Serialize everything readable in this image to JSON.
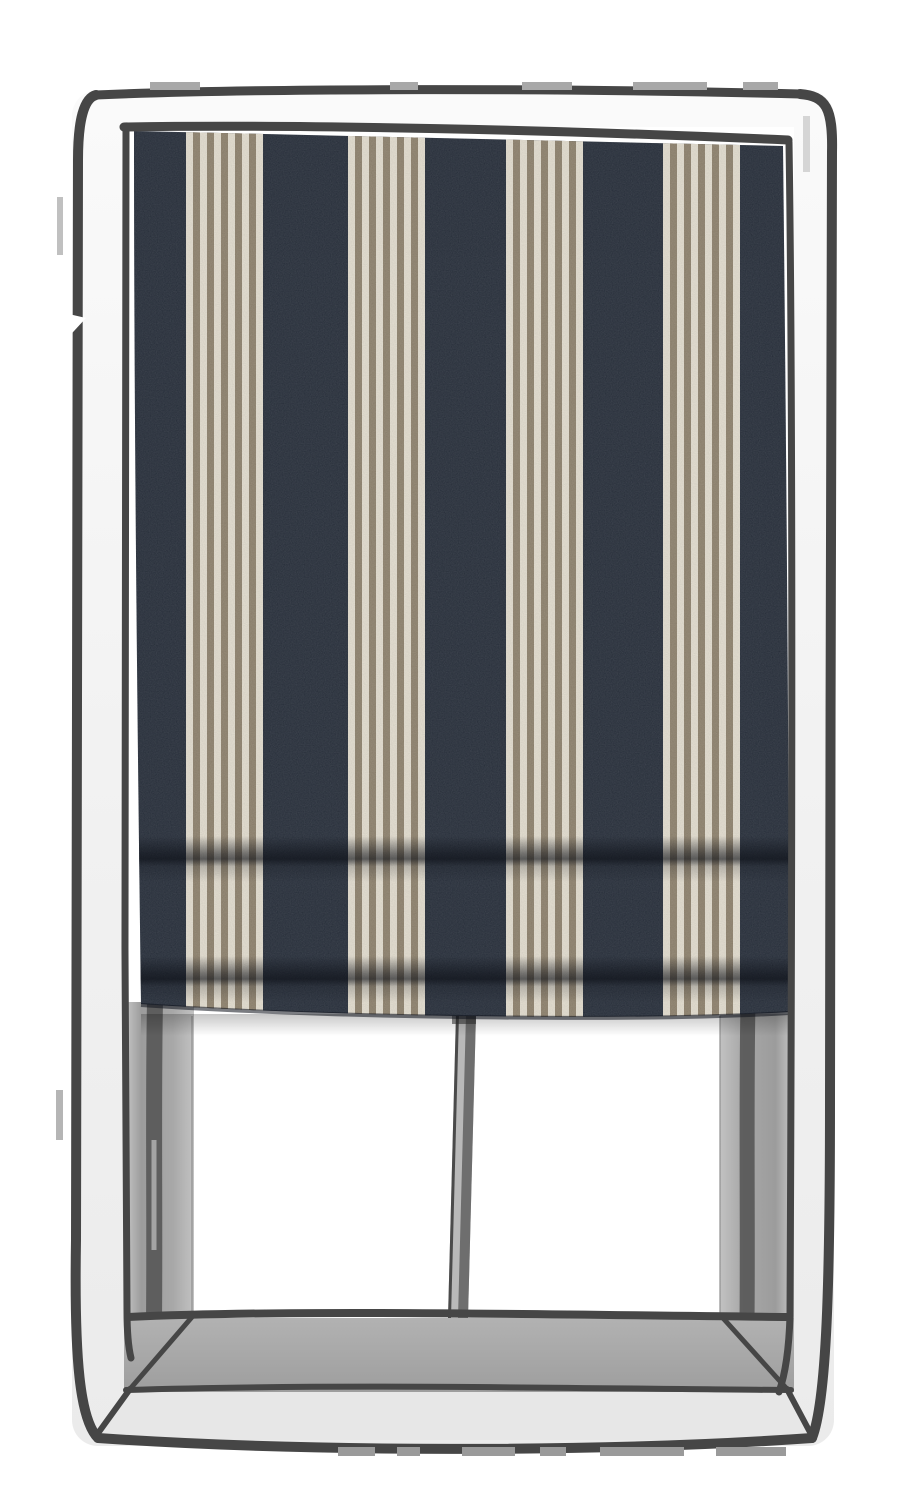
{
  "window_product_image": {
    "description": "Hand-sketched white window frame with a navy blue and taupe ticking-stripe roman shade lowered over the top three quarters; two white window panes and a grey sill visible below",
    "style": "sketch product illustration, no text",
    "colors": {
      "page_background": "#ffffff",
      "fabric_navy": "#202835",
      "stripe_cream": "#e8e2d3",
      "stripe_taupe": "#8e816b",
      "sketch_line": "#464646",
      "frame_face_top": "#fafafa",
      "frame_face_side": "#eeeeee",
      "frame_face_bottom": "#e7e7e7",
      "jamb_gray": "#9c9c9c",
      "jamb_streak": "#565656",
      "sill_gray": "#a6a6a6",
      "mullion_light": "#bcbcbc",
      "mullion_dark": "#6e6e6e",
      "pane_white": "#ffffff",
      "accent_dash_gray": "#a8a8a8"
    },
    "shade": {
      "left_x": 134,
      "right_x": 786,
      "top_y": 131,
      "bottom_edge_y": 1016,
      "stripe_band_positions_x": [
        186,
        348,
        506,
        663
      ],
      "stripe_sequence": [
        "cream",
        "taupe",
        "cream",
        "taupe",
        "cream",
        "taupe",
        "cream",
        "taupe",
        "cream",
        "taupe",
        "cream"
      ],
      "stripe_width": 7,
      "fold_shadow_positions_y": [
        858,
        978
      ]
    },
    "frame": {
      "panes": 2,
      "top_sketch_dashes_x": [
        [
          150,
          200
        ],
        [
          390,
          418
        ],
        [
          522,
          572
        ],
        [
          633,
          707
        ],
        [
          743,
          778
        ]
      ],
      "bottom_sketch_dashes_x": [
        [
          338,
          375
        ],
        [
          397,
          420
        ],
        [
          462,
          515
        ],
        [
          540,
          566
        ],
        [
          600,
          684
        ],
        [
          716,
          786
        ]
      ]
    }
  }
}
